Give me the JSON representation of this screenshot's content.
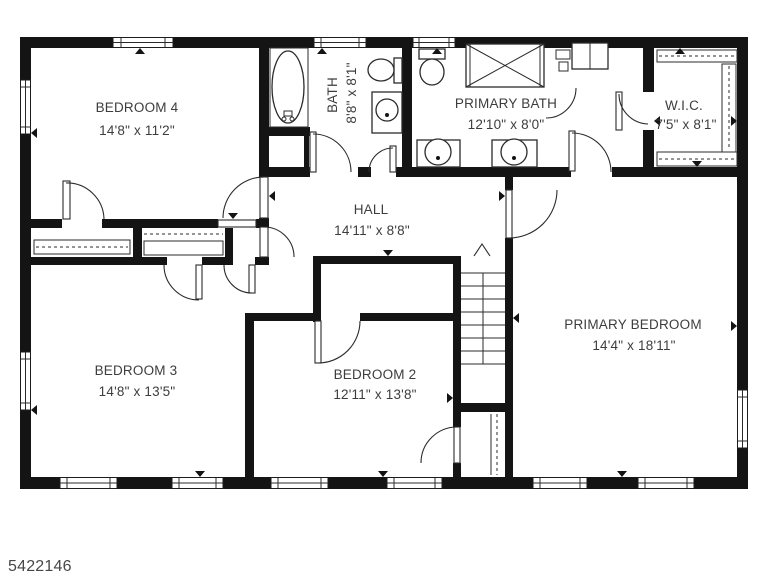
{
  "floorplan": {
    "watermark": "5422146",
    "rooms": [
      {
        "name": "BEDROOM 4",
        "dims": "14'8\" x 11'2\""
      },
      {
        "name": "BATH",
        "dims": "8'8\" x 8'1\""
      },
      {
        "name": "PRIMARY BATH",
        "dims": "12'10\" x 8'0\""
      },
      {
        "name": "W.I.C.",
        "dims": "7'5\" x 8'1\""
      },
      {
        "name": "HALL",
        "dims": "14'11\" x 8'8\""
      },
      {
        "name": "BEDROOM 3",
        "dims": "14'8\" x 13'5\""
      },
      {
        "name": "BEDROOM 2",
        "dims": "12'11\" x 13'8\""
      },
      {
        "name": "PRIMARY BEDROOM",
        "dims": "14'4\" x 18'11\""
      }
    ],
    "icons": [
      "bathtub",
      "toilet",
      "shower",
      "sink-vanity",
      "double-vanity",
      "linen-cabinet",
      "closet-shelves",
      "stairs-up-arrow",
      "door-swing",
      "window"
    ],
    "colors": {
      "wall": "#141414",
      "text": "#3d3d3d",
      "background": "#ffffff"
    }
  }
}
